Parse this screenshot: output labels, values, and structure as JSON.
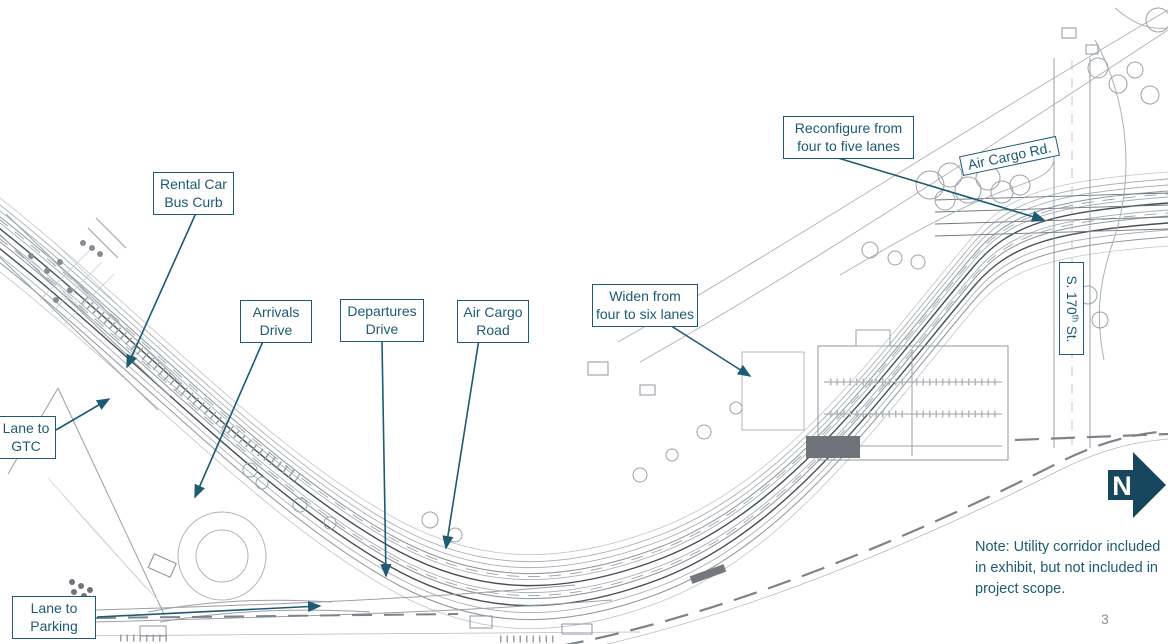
{
  "colors": {
    "accent": "#1d5a73",
    "north_arrow_fill": "#17475c",
    "drawing_line_light": "#a8aeb3",
    "drawing_line_dark": "#4a4e53"
  },
  "callouts": {
    "rental_car_bus_curb": {
      "line1": "Rental Car",
      "line2": "Bus Curb"
    },
    "arrivals_drive": {
      "line1": "Arrivals",
      "line2": "Drive"
    },
    "departures_drive": {
      "line1": "Departures",
      "line2": "Drive"
    },
    "air_cargo_road": {
      "line1": "Air Cargo",
      "line2": "Road"
    },
    "widen": {
      "line1": "Widen from",
      "line2": "four to six lanes"
    },
    "reconfigure": {
      "line1": "Reconfigure from",
      "line2": "four to five lanes"
    },
    "lane_to_gtc": {
      "line1": "Lane to",
      "line2": "GTC"
    },
    "lane_to_parking": {
      "line1": "Lane to",
      "line2": "Parking"
    }
  },
  "road_labels": {
    "air_cargo_rd": "Air Cargo Rd.",
    "s_170th": {
      "prefix": "S. 170",
      "sup": "th",
      "suffix": " St."
    }
  },
  "note": {
    "line1": "Note: Utility corridor included",
    "line2": "in exhibit, but not included in",
    "line3": "project scope."
  },
  "north_arrow": {
    "letter": "N"
  },
  "page_number": "3"
}
